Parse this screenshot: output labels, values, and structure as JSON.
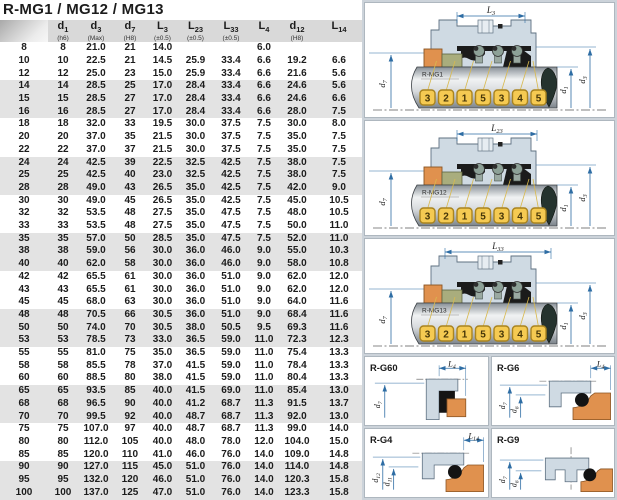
{
  "title": "R-MG1 / MG12 / MG13",
  "table": {
    "columns": [
      {
        "base": "",
        "sub": "",
        "note": ""
      },
      {
        "base": "d",
        "sub": "1",
        "note": "(h6)"
      },
      {
        "base": "d",
        "sub": "3",
        "note": "(Max)"
      },
      {
        "base": "d",
        "sub": "7",
        "note": "(H8)"
      },
      {
        "base": "L",
        "sub": "3",
        "note": "(±0.5)"
      },
      {
        "base": "L",
        "sub": "23",
        "note": "(±0.5)"
      },
      {
        "base": "L",
        "sub": "33",
        "note": "(±0.5)"
      },
      {
        "base": "L",
        "sub": "4",
        "note": ""
      },
      {
        "base": "d",
        "sub": "12",
        "note": "(H8)"
      },
      {
        "base": "L",
        "sub": "14",
        "note": ""
      }
    ],
    "rows": [
      [
        "8",
        "8",
        "21.0",
        "21",
        "14.0",
        "",
        "",
        "6.0",
        "",
        ""
      ],
      [
        "10",
        "10",
        "22.5",
        "21",
        "14.5",
        "25.9",
        "33.4",
        "6.6",
        "19.2",
        "6.6"
      ],
      [
        "12",
        "12",
        "25.0",
        "23",
        "15.0",
        "25.9",
        "33.4",
        "6.6",
        "21.6",
        "5.6"
      ],
      [
        "14",
        "14",
        "28.5",
        "25",
        "17.0",
        "28.4",
        "33.4",
        "6.6",
        "24.6",
        "5.6"
      ],
      [
        "15",
        "15",
        "28.5",
        "27",
        "17.0",
        "28.4",
        "33.4",
        "6.6",
        "24.6",
        "6.6"
      ],
      [
        "16",
        "16",
        "28.5",
        "27",
        "17.0",
        "28.4",
        "33.4",
        "6.6",
        "28.0",
        "7.5"
      ],
      [
        "18",
        "18",
        "32.0",
        "33",
        "19.5",
        "30.0",
        "37.5",
        "7.5",
        "30.0",
        "8.0"
      ],
      [
        "20",
        "20",
        "37.0",
        "35",
        "21.5",
        "30.0",
        "37.5",
        "7.5",
        "35.0",
        "7.5"
      ],
      [
        "22",
        "22",
        "37.0",
        "37",
        "21.5",
        "30.0",
        "37.5",
        "7.5",
        "35.0",
        "7.5"
      ],
      [
        "24",
        "24",
        "42.5",
        "39",
        "22.5",
        "32.5",
        "42.5",
        "7.5",
        "38.0",
        "7.5"
      ],
      [
        "25",
        "25",
        "42.5",
        "40",
        "23.0",
        "32.5",
        "42.5",
        "7.5",
        "38.0",
        "7.5"
      ],
      [
        "28",
        "28",
        "49.0",
        "43",
        "26.5",
        "35.0",
        "42.5",
        "7.5",
        "42.0",
        "9.0"
      ],
      [
        "30",
        "30",
        "49.0",
        "45",
        "26.5",
        "35.0",
        "42.5",
        "7.5",
        "45.0",
        "10.5"
      ],
      [
        "32",
        "32",
        "53.5",
        "48",
        "27.5",
        "35.0",
        "47.5",
        "7.5",
        "48.0",
        "10.5"
      ],
      [
        "33",
        "33",
        "53.5",
        "48",
        "27.5",
        "35.0",
        "47.5",
        "7.5",
        "50.0",
        "11.0"
      ],
      [
        "35",
        "35",
        "57.0",
        "50",
        "28.5",
        "35.0",
        "47.5",
        "7.5",
        "52.0",
        "11.0"
      ],
      [
        "38",
        "38",
        "59.0",
        "56",
        "30.0",
        "36.0",
        "46.0",
        "9.0",
        "55.0",
        "10.3"
      ],
      [
        "40",
        "40",
        "62.0",
        "58",
        "30.0",
        "36.0",
        "46.0",
        "9.0",
        "58.0",
        "10.8"
      ],
      [
        "42",
        "42",
        "65.5",
        "61",
        "30.0",
        "36.0",
        "51.0",
        "9.0",
        "62.0",
        "12.0"
      ],
      [
        "43",
        "43",
        "65.5",
        "61",
        "30.0",
        "36.0",
        "51.0",
        "9.0",
        "62.0",
        "12.0"
      ],
      [
        "45",
        "45",
        "68.0",
        "63",
        "30.0",
        "36.0",
        "51.0",
        "9.0",
        "64.0",
        "11.6"
      ],
      [
        "48",
        "48",
        "70.5",
        "66",
        "30.5",
        "36.0",
        "51.0",
        "9.0",
        "68.4",
        "11.6"
      ],
      [
        "50",
        "50",
        "74.0",
        "70",
        "30.5",
        "38.0",
        "50.5",
        "9.5",
        "69.3",
        "11.6"
      ],
      [
        "53",
        "53",
        "78.5",
        "73",
        "33.0",
        "36.5",
        "59.0",
        "11.0",
        "72.3",
        "12.3"
      ],
      [
        "55",
        "55",
        "81.0",
        "75",
        "35.0",
        "36.5",
        "59.0",
        "11.0",
        "75.4",
        "13.3"
      ],
      [
        "58",
        "58",
        "85.5",
        "78",
        "37.0",
        "41.5",
        "59.0",
        "11.0",
        "78.4",
        "13.3"
      ],
      [
        "60",
        "60",
        "88.5",
        "80",
        "38.0",
        "41.5",
        "59.0",
        "11.0",
        "80.4",
        "13.3"
      ],
      [
        "65",
        "65",
        "93.5",
        "85",
        "40.0",
        "41.5",
        "69.0",
        "11.0",
        "85.4",
        "13.0"
      ],
      [
        "68",
        "68",
        "96.5",
        "90",
        "40.0",
        "41.2",
        "68.7",
        "11.3",
        "91.5",
        "13.7"
      ],
      [
        "70",
        "70",
        "99.5",
        "92",
        "40.0",
        "48.7",
        "68.7",
        "11.3",
        "92.0",
        "13.0"
      ],
      [
        "75",
        "75",
        "107.0",
        "97",
        "40.0",
        "48.7",
        "68.7",
        "11.3",
        "99.0",
        "14.0"
      ],
      [
        "80",
        "80",
        "112.0",
        "105",
        "40.0",
        "48.0",
        "78.0",
        "12.0",
        "104.0",
        "15.0"
      ],
      [
        "85",
        "85",
        "120.0",
        "110",
        "41.0",
        "46.0",
        "76.0",
        "14.0",
        "109.0",
        "14.8"
      ],
      [
        "90",
        "90",
        "127.0",
        "115",
        "45.0",
        "51.0",
        "76.0",
        "14.0",
        "114.0",
        "14.8"
      ],
      [
        "95",
        "95",
        "132.0",
        "120",
        "46.0",
        "51.0",
        "76.0",
        "14.0",
        "120.3",
        "15.8"
      ],
      [
        "100",
        "100",
        "137.0",
        "125",
        "47.0",
        "51.0",
        "76.0",
        "14.0",
        "123.3",
        "15.8"
      ]
    ]
  },
  "diagrams": {
    "callouts": [
      "3",
      "2",
      "1",
      "5",
      "3",
      "4",
      "5"
    ],
    "main": [
      {
        "label": "R-MG1",
        "dim": {
          "base": "L",
          "sub": "3"
        }
      },
      {
        "label": "R-MG12",
        "dim": {
          "base": "L",
          "sub": "23"
        }
      },
      {
        "label": "R-MG13",
        "dim": {
          "base": "L",
          "sub": "33"
        }
      }
    ],
    "seats": [
      {
        "label": "R-G60",
        "style": "lseal",
        "top_dim": {
          "base": "L",
          "sub": "4"
        },
        "left_dims": [
          {
            "base": "d",
            "sub": "7"
          }
        ]
      },
      {
        "label": "R-G6",
        "style": "oring",
        "top_dim": {
          "base": "L",
          "sub": "4"
        },
        "left_dims": [
          {
            "base": "d",
            "sub": "7"
          },
          {
            "base": "d",
            "sub": "6"
          }
        ]
      },
      {
        "label": "R-G4",
        "style": "oring",
        "top_dim": {
          "base": "L",
          "sub": "14"
        },
        "left_dims": [
          {
            "base": "d",
            "sub": "12"
          },
          {
            "base": "d",
            "sub": "11"
          }
        ]
      },
      {
        "label": "R-G9",
        "style": "oring9",
        "top_dim": null,
        "left_dims": [
          {
            "base": "d",
            "sub": "7"
          },
          {
            "base": "d",
            "sub": "6"
          }
        ]
      }
    ]
  },
  "colors": {
    "accent_blue": "#2e6da4",
    "housing_blue": "#cfdae3",
    "seat_orange": "#e0914e",
    "face_olive": "#a9ad7d",
    "tag_yellow": "#f5ca52",
    "black_part": "#1b1b1b",
    "panel_bg": "#ccd3da",
    "header_gray": "#d9d9d9",
    "band_gray": "#e3e3e3"
  }
}
